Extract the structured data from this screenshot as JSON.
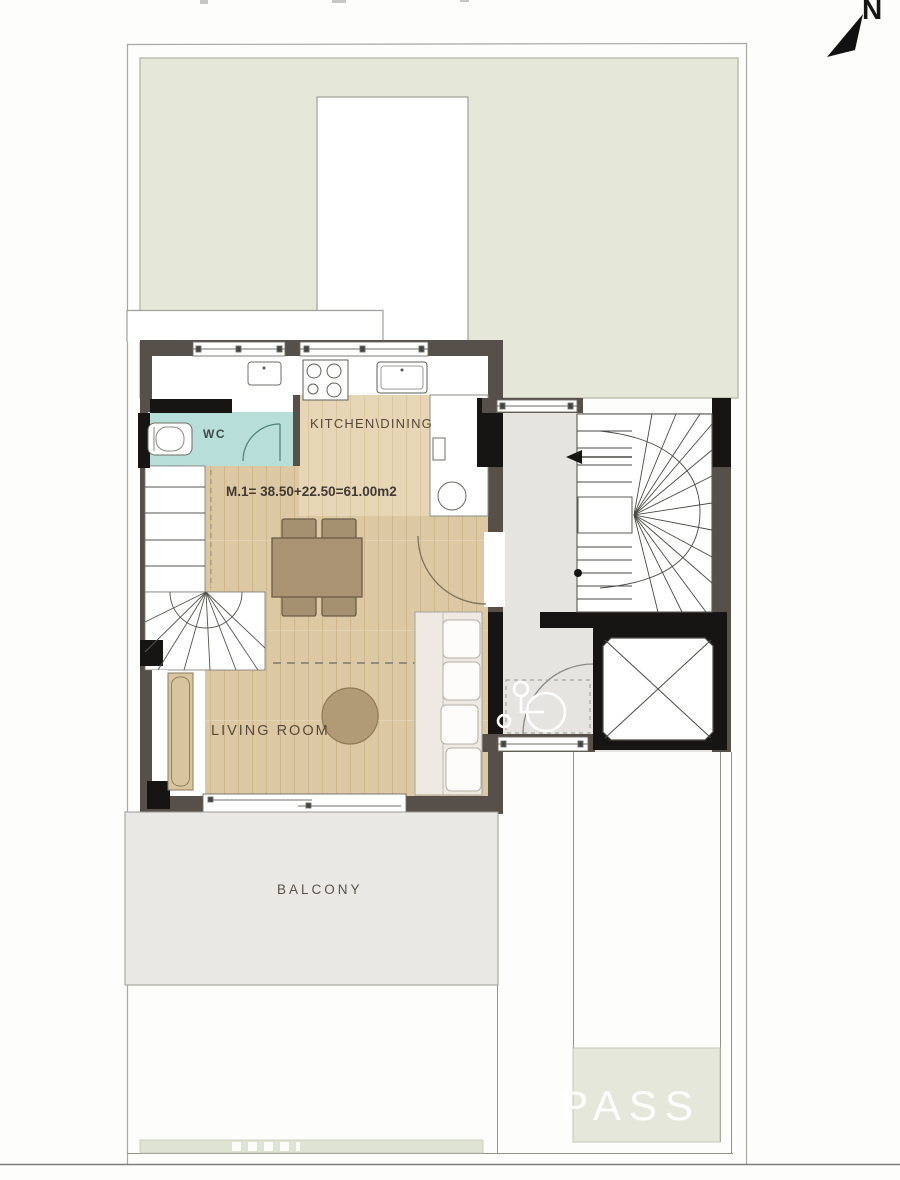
{
  "plan": {
    "north_label": "N",
    "rooms": {
      "wc": "WC",
      "kitchen_dining": "KITCHEN\\DINING",
      "living_room": "LIVING ROOM",
      "balcony": "BALCONY"
    },
    "area_annotation": "M.1= 38.50+22.50=61.00m2",
    "watermark": "PASS"
  },
  "icons": {
    "north_arrow": "filled-triangle-pointing-northeast",
    "wheelchair": "accessibility-wheelchair-symbol",
    "elevator": "x-crossed-shaft"
  },
  "colors": {
    "terrace_green": "#e5e8d9",
    "bottom_green_box": "#e4e7d9",
    "wc_teal": "#b7ded9",
    "wood_floor": "#dcc9a3",
    "kitchen_floor": "#e4d4b4",
    "wall_brown": "#57504a",
    "wall_black": "#161513",
    "corridor_gray": "#e6e4e1",
    "balcony_gray": "#e9e8e4",
    "table_brown": "#aa9372"
  }
}
